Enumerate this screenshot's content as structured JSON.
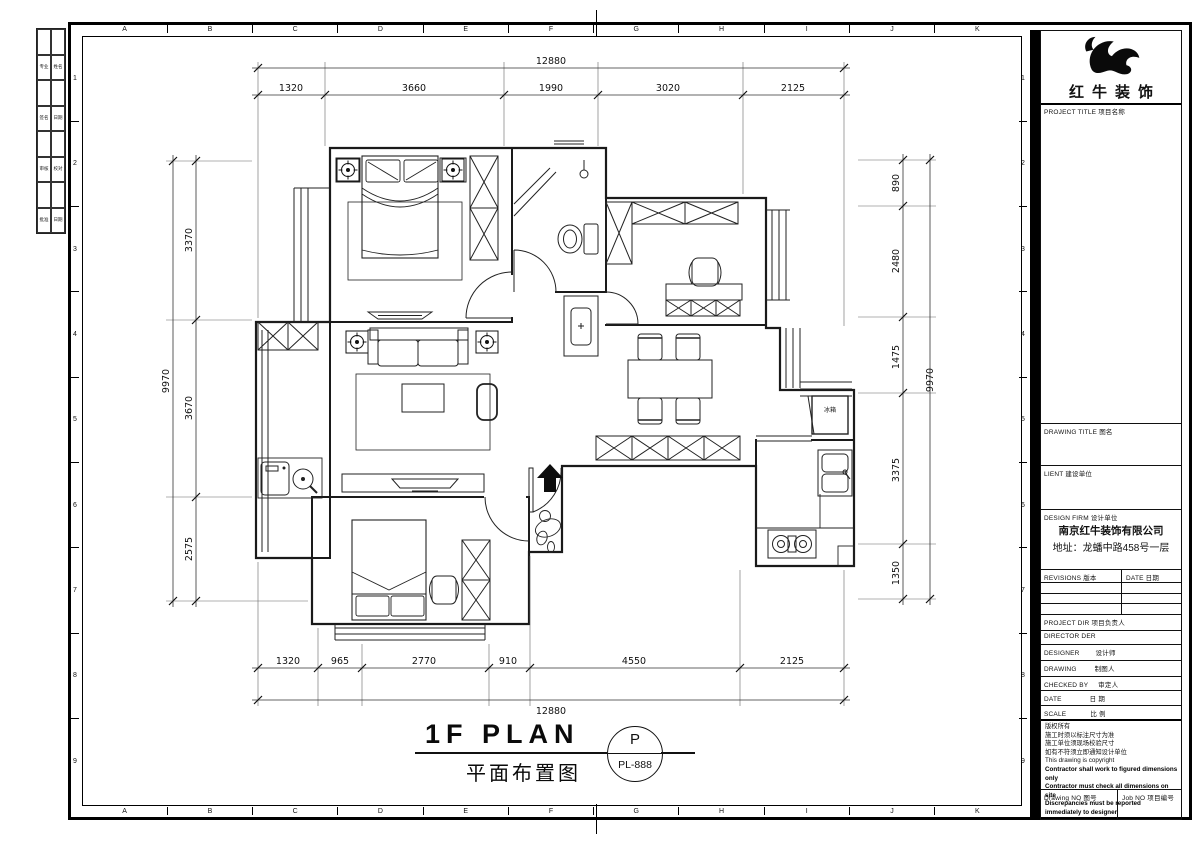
{
  "sheet": {
    "grid_letters": [
      "A",
      "B",
      "C",
      "D",
      "E",
      "F",
      "G",
      "H",
      "I",
      "J",
      "K"
    ],
    "grid_numbers": [
      "1",
      "2",
      "3",
      "4",
      "5",
      "6",
      "7",
      "8",
      "9"
    ],
    "binding_cells": [
      "",
      "",
      "专业",
      "姓名",
      "",
      "",
      "签名",
      "日期",
      "",
      "",
      "审核",
      "校对",
      "",
      "",
      "批准",
      "日期"
    ]
  },
  "plan": {
    "title_en": "1F PLAN",
    "title_zh": "平面布置图",
    "badge": {
      "letter": "P",
      "code": "PL-888"
    },
    "fridge_label": "冰箱",
    "dims": {
      "top": {
        "overall": "12880",
        "segments": [
          "1320",
          "3660",
          "1990",
          "3020",
          "2125"
        ]
      },
      "bottom": {
        "overall": "12880",
        "segments": [
          "1320",
          "965",
          "2770",
          "910",
          "4550",
          "2125"
        ]
      },
      "left": {
        "overall": "9970",
        "segments": [
          "3370",
          "3670",
          "2575"
        ]
      },
      "right": {
        "overall": "9970",
        "segments": [
          "890",
          "2480",
          "1475",
          "3375",
          "1350"
        ]
      }
    }
  },
  "title_block": {
    "brand": "红牛装饰",
    "project_title": {
      "en": "PROJECT TITLE",
      "zh": "项目名称"
    },
    "drawing_title": {
      "en": "DRAWING TITLE",
      "zh": "图名"
    },
    "client": {
      "en": "LIENT",
      "zh": "建设单位"
    },
    "design_firm": {
      "en": "DESIGN FIRM",
      "zh": "设计单位",
      "company": "南京红牛装饰有限公司",
      "address": "地址：龙蟠中路458号一层"
    },
    "revisions": {
      "en": "REVISIONS",
      "zh": "版本"
    },
    "date_col": {
      "en": "DATE",
      "zh": "日期"
    },
    "project_dir": {
      "en": "PROJECT DIR",
      "zh": "项目负责人"
    },
    "director": {
      "en": "DIRECTOR DER",
      "zh": ""
    },
    "designer": {
      "en": "DESIGNER",
      "zh": "设计师"
    },
    "drawing_by": {
      "en": "DRAWING",
      "zh": "制图人"
    },
    "checked_by": {
      "en": "CHECKED BY",
      "zh": "审定人"
    },
    "date": {
      "en": "DATE",
      "zh": "日 期"
    },
    "scale": {
      "en": "SCALE",
      "zh": "比 例"
    },
    "copyright_lines": [
      "版权所有",
      "施工时须以标注尺寸为准",
      "施工单位须现场校验尺寸",
      "如有不符须立即通知设计单位",
      "This drawing is copyright"
    ],
    "copyright_bold_lines": [
      "Contractor shall work to figured dimensions only",
      "Contractor must check all dimensions on site",
      "Discrepancies must be reported immediately to designer"
    ],
    "drawing_no": {
      "en": "Drawing NO",
      "zh": "图号"
    },
    "job_no": {
      "en": "Job NO",
      "zh": "项目编号"
    }
  }
}
